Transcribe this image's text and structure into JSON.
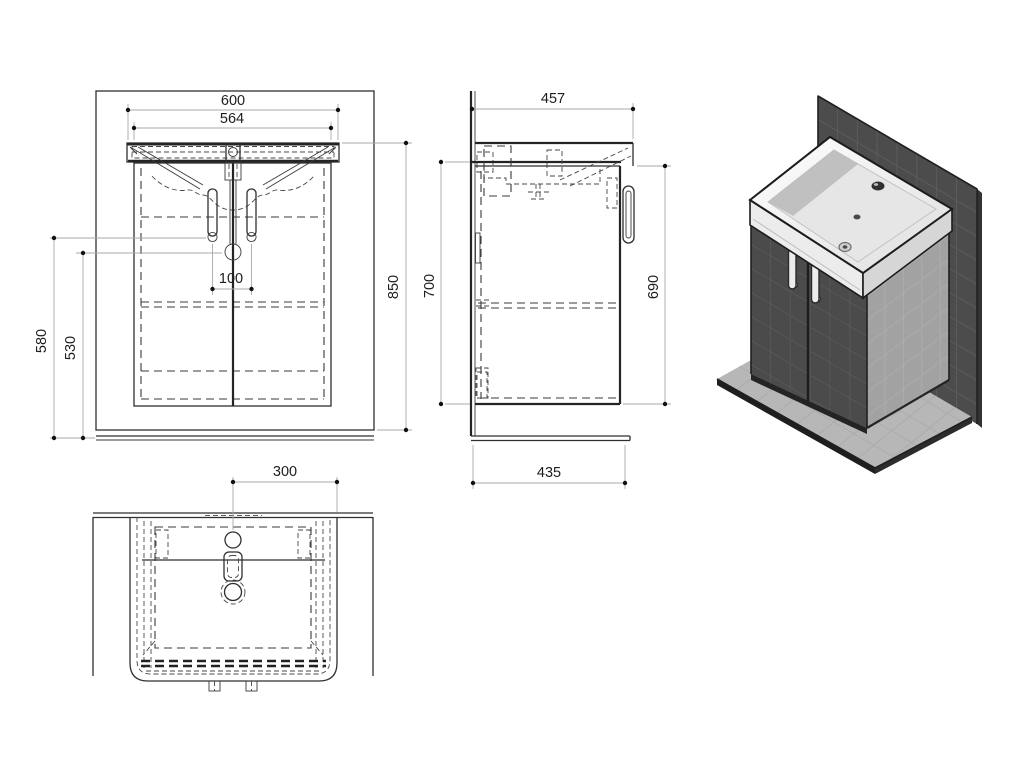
{
  "drawing": {
    "dims": {
      "front": {
        "width_top": "600",
        "width_basin": "564",
        "height_total": "850",
        "height_outer_left": "580",
        "height_inner_left": "530",
        "handle_spacing": "100"
      },
      "side": {
        "depth_top": "457",
        "height_back": "700",
        "height_front": "690",
        "depth_base": "435"
      },
      "plan": {
        "center_to_edge": "300"
      }
    },
    "colors": {
      "background": "#ffffff",
      "line": "#2f2f2f",
      "hidden_line": "#3a3a3a",
      "dim_line": "#a9a9a9",
      "dim_text": "#1c1c1c",
      "wall_3d": "#4c4c4c",
      "wall_grid": "#5d5d5d",
      "cabinet_front": "#4b4b4b",
      "cabinet_side": "#a2a2a2",
      "floor_plate": "#b7b7b7",
      "sink_ceramic": "#f4f4f4",
      "sink_basin_shade": "#b9b9b9"
    }
  }
}
